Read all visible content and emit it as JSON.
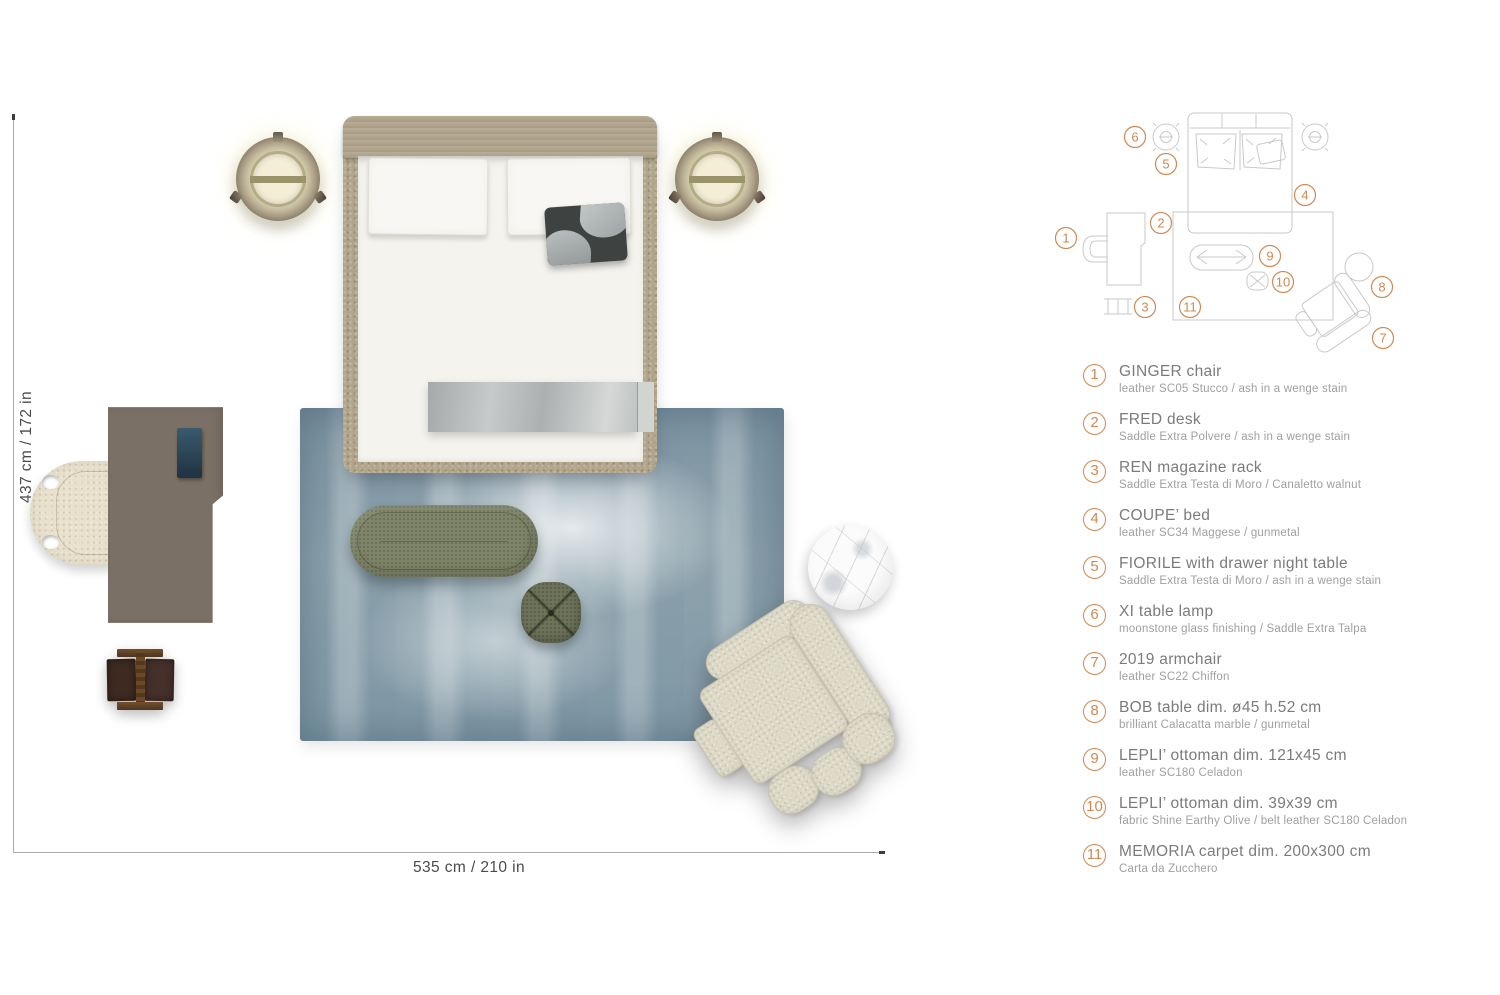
{
  "colors": {
    "accent": "#cd8a52",
    "plan_stroke": "#c9c9c9",
    "title_text": "#7b7b7b",
    "subtitle_text": "#9f9f9f"
  },
  "dimensions": {
    "vertical_label": "437 cm / 172 in",
    "horizontal_label": "535 cm / 210 in"
  },
  "legend": {
    "items": [
      {
        "num": "1",
        "title": "GINGER chair",
        "subtitle": "leather SC05 Stucco / ash in a wenge stain"
      },
      {
        "num": "2",
        "title": "FRED desk",
        "subtitle": "Saddle Extra Polvere / ash in a wenge stain"
      },
      {
        "num": "3",
        "title": "REN magazine rack",
        "subtitle": "Saddle Extra Testa di Moro / Canaletto walnut"
      },
      {
        "num": "4",
        "title": "COUPE’ bed",
        "subtitle": "leather SC34 Maggese / gunmetal"
      },
      {
        "num": "5",
        "title": "FIORILE with drawer night table",
        "subtitle": "Saddle Extra Testa di Moro / ash in a wenge stain"
      },
      {
        "num": "6",
        "title": "XI table lamp",
        "subtitle": "moonstone glass finishing / Saddle Extra Talpa"
      },
      {
        "num": "7",
        "title": "2019 armchair",
        "subtitle": "leather SC22 Chiffon"
      },
      {
        "num": "8",
        "title": "BOB table dim. ø45 h.52 cm",
        "subtitle": "brilliant Calacatta marble / gunmetal"
      },
      {
        "num": "9",
        "title": "LEPLI’ ottoman dim. 121x45 cm",
        "subtitle": "leather SC180 Celadon"
      },
      {
        "num": "10",
        "title": "LEPLI’ ottoman dim. 39x39 cm",
        "subtitle": "fabric Shine Earthy Olive / belt leather SC180 Celadon"
      },
      {
        "num": "11",
        "title": "MEMORIA carpet dim. 200x300 cm",
        "subtitle": "Carta da Zucchero"
      }
    ]
  },
  "plan": {
    "badges": [
      {
        "num": "1",
        "x": 16,
        "y": 138
      },
      {
        "num": "2",
        "x": 111,
        "y": 123
      },
      {
        "num": "3",
        "x": 95,
        "y": 207
      },
      {
        "num": "4",
        "x": 255,
        "y": 95
      },
      {
        "num": "5",
        "x": 116,
        "y": 64
      },
      {
        "num": "6",
        "x": 85,
        "y": 37
      },
      {
        "num": "7",
        "x": 333,
        "y": 238
      },
      {
        "num": "8",
        "x": 332,
        "y": 187
      },
      {
        "num": "9",
        "x": 220,
        "y": 156
      },
      {
        "num": "10",
        "x": 233,
        "y": 182
      },
      {
        "num": "11",
        "x": 140,
        "y": 207
      }
    ]
  }
}
